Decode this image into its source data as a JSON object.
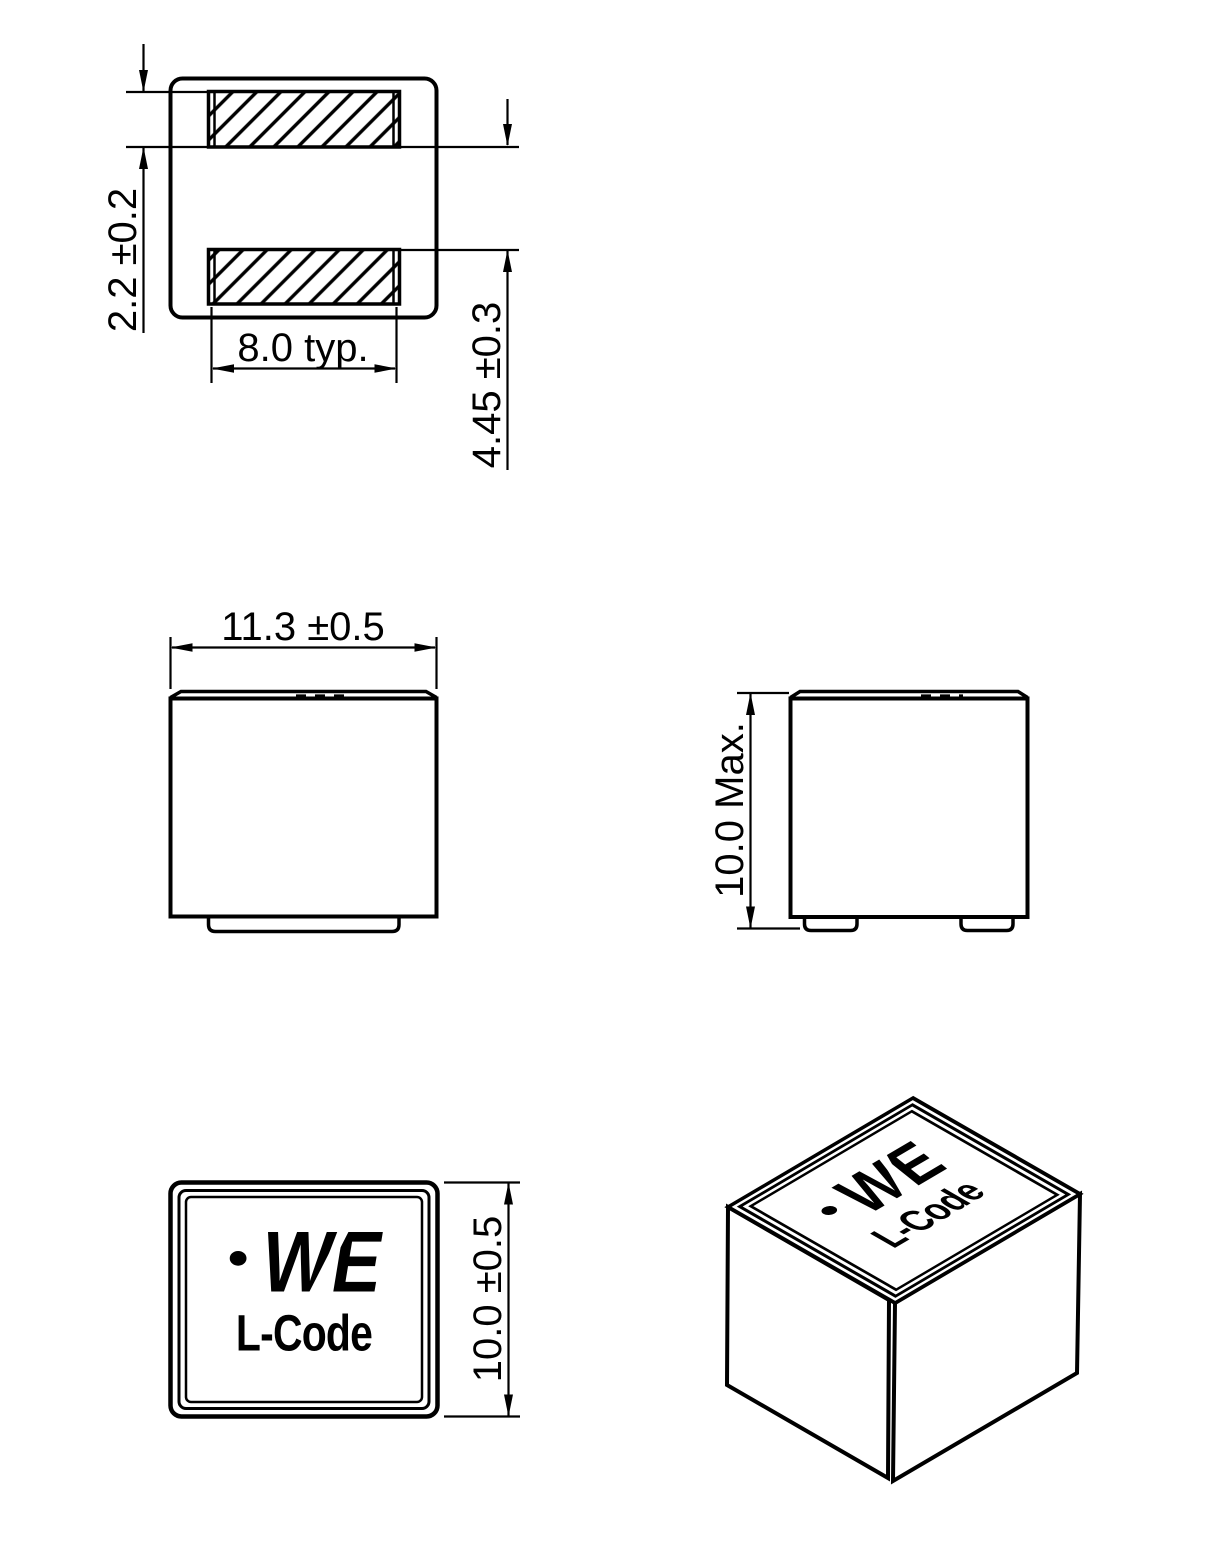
{
  "colors": {
    "line": "#000000",
    "background": "#ffffff"
  },
  "marking": {
    "logo": "WE",
    "code": "L-Code"
  },
  "views": {
    "land_pattern": {
      "dim_pad_height": "2.2 ±0.2",
      "dim_pad_width": "8.0 typ.",
      "dim_pad_spacing": "4.45 ±0.3"
    },
    "front": {
      "dim_width": "11.3 ±0.5"
    },
    "side": {
      "dim_height": "10.0 Max."
    },
    "top": {
      "dim_depth": "10.0 ±0.5"
    }
  }
}
